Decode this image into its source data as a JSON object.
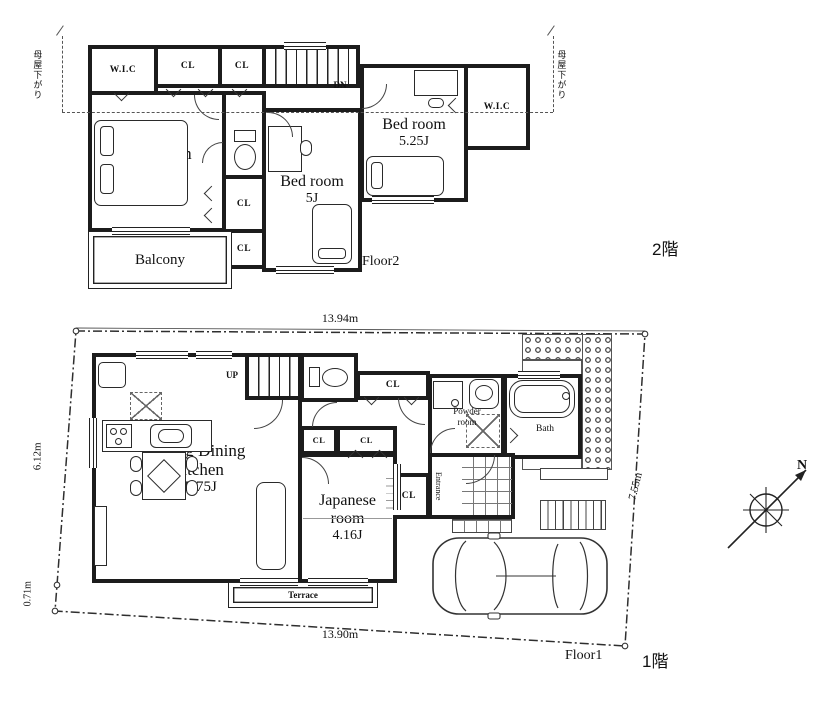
{
  "floor2": {
    "floor_label": "Floor2",
    "floor_tag": "2階",
    "roof_note_left": "母屋下がり",
    "roof_note_right": "母屋下がり",
    "stairs_dn": "DN",
    "wic_left": "W.I.C",
    "cl_top_1": "CL",
    "cl_top_2": "CL",
    "cl_mid": "CL",
    "cl_low": "CL",
    "bedroom_main": {
      "name": "Bed room",
      "size": "6.75J"
    },
    "bedroom_center": {
      "name": "Bed room",
      "size": "5J"
    },
    "bedroom_right": {
      "name": "Bed room",
      "size": "5.25J"
    },
    "wic_right": "W.I.C",
    "balcony": "Balcony"
  },
  "floor1": {
    "floor_label": "Floor1",
    "floor_tag": "1階",
    "stairs_up": "UP",
    "hall_cl": "CL",
    "ldk": {
      "line1": "Living Dining",
      "line2": "Kitchen",
      "size": "15.75J"
    },
    "japanese": {
      "line1": "Japanese",
      "line2": "room",
      "size": "4.16J"
    },
    "powder": {
      "line1": "Powder",
      "line2": "room"
    },
    "bath": "Bath",
    "scl": "SCL",
    "entrance": "Entrance",
    "cl_1": "CL",
    "cl_2": "CL",
    "terrace": "Terrace",
    "dimensions": {
      "top": "13.94m",
      "bottom": "13.90m",
      "left": "6.12m",
      "left_lower": "0.71m",
      "right": "7.55m"
    }
  },
  "compass": {
    "north": "N"
  },
  "colors": {
    "wall": "#1c1c1c",
    "line": "#333333",
    "paper": "#ffffff"
  }
}
